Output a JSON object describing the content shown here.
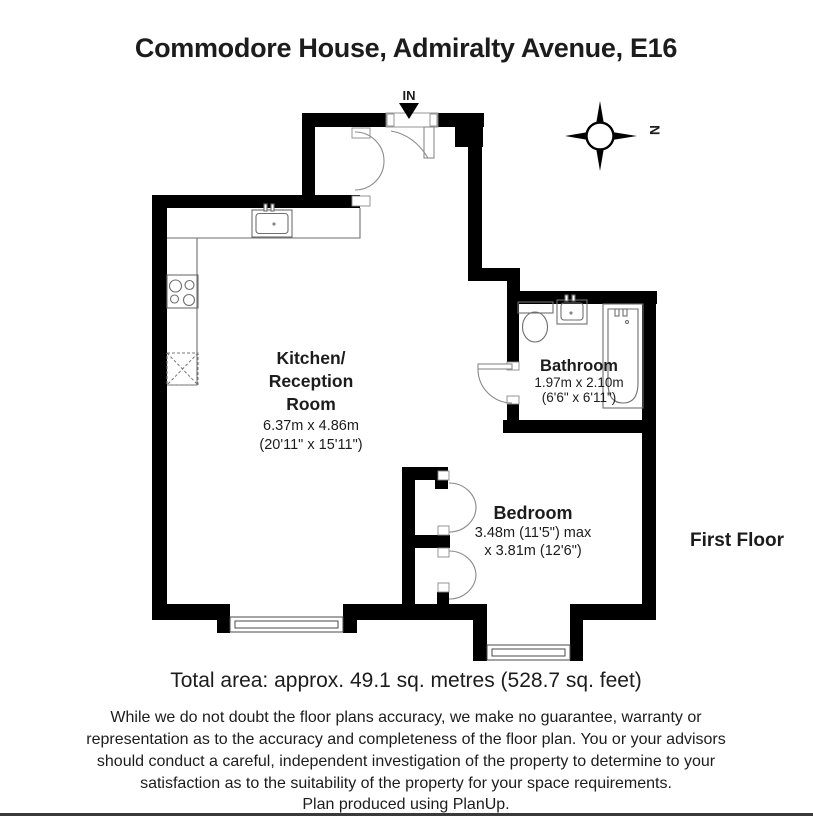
{
  "page": {
    "title": "Commodore House, Admiralty Avenue, E16",
    "floor_label": "First Floor",
    "total_area_text": "Total area: approx. 49.1 sq. metres (528.7 sq. feet)",
    "background_color": "#ffffff",
    "wall_color": "#000000"
  },
  "plan": {
    "entrance_label": "IN",
    "compass_letter": "N",
    "rooms": {
      "kitchen": {
        "name_line1": "Kitchen/",
        "name_line2": "Reception",
        "name_line3": "Room",
        "dims_metric": "6.37m x 4.86m",
        "dims_imperial": "(20'11\" x 15'11\")"
      },
      "bathroom": {
        "name": "Bathroom",
        "dims_metric": "1.97m x 2.10m",
        "dims_imperial": "(6'6\" x 6'11\")"
      },
      "bedroom": {
        "name": "Bedroom",
        "dims_line1": "3.48m (11'5\") max",
        "dims_line2": "x 3.81m (12'6\")"
      }
    }
  },
  "footer": {
    "disclaimer_line1": "While we do not doubt the floor plans accuracy, we make no guarantee, warranty or",
    "disclaimer_line2": "representation as to the accuracy and completeness of the floor plan. You or your advisors",
    "disclaimer_line3": "should conduct a careful, independent investigation of the property to determine to your",
    "disclaimer_line4": "satisfaction as to the suitability of the property for your space requirements.",
    "credit": "Plan produced using PlanUp."
  }
}
